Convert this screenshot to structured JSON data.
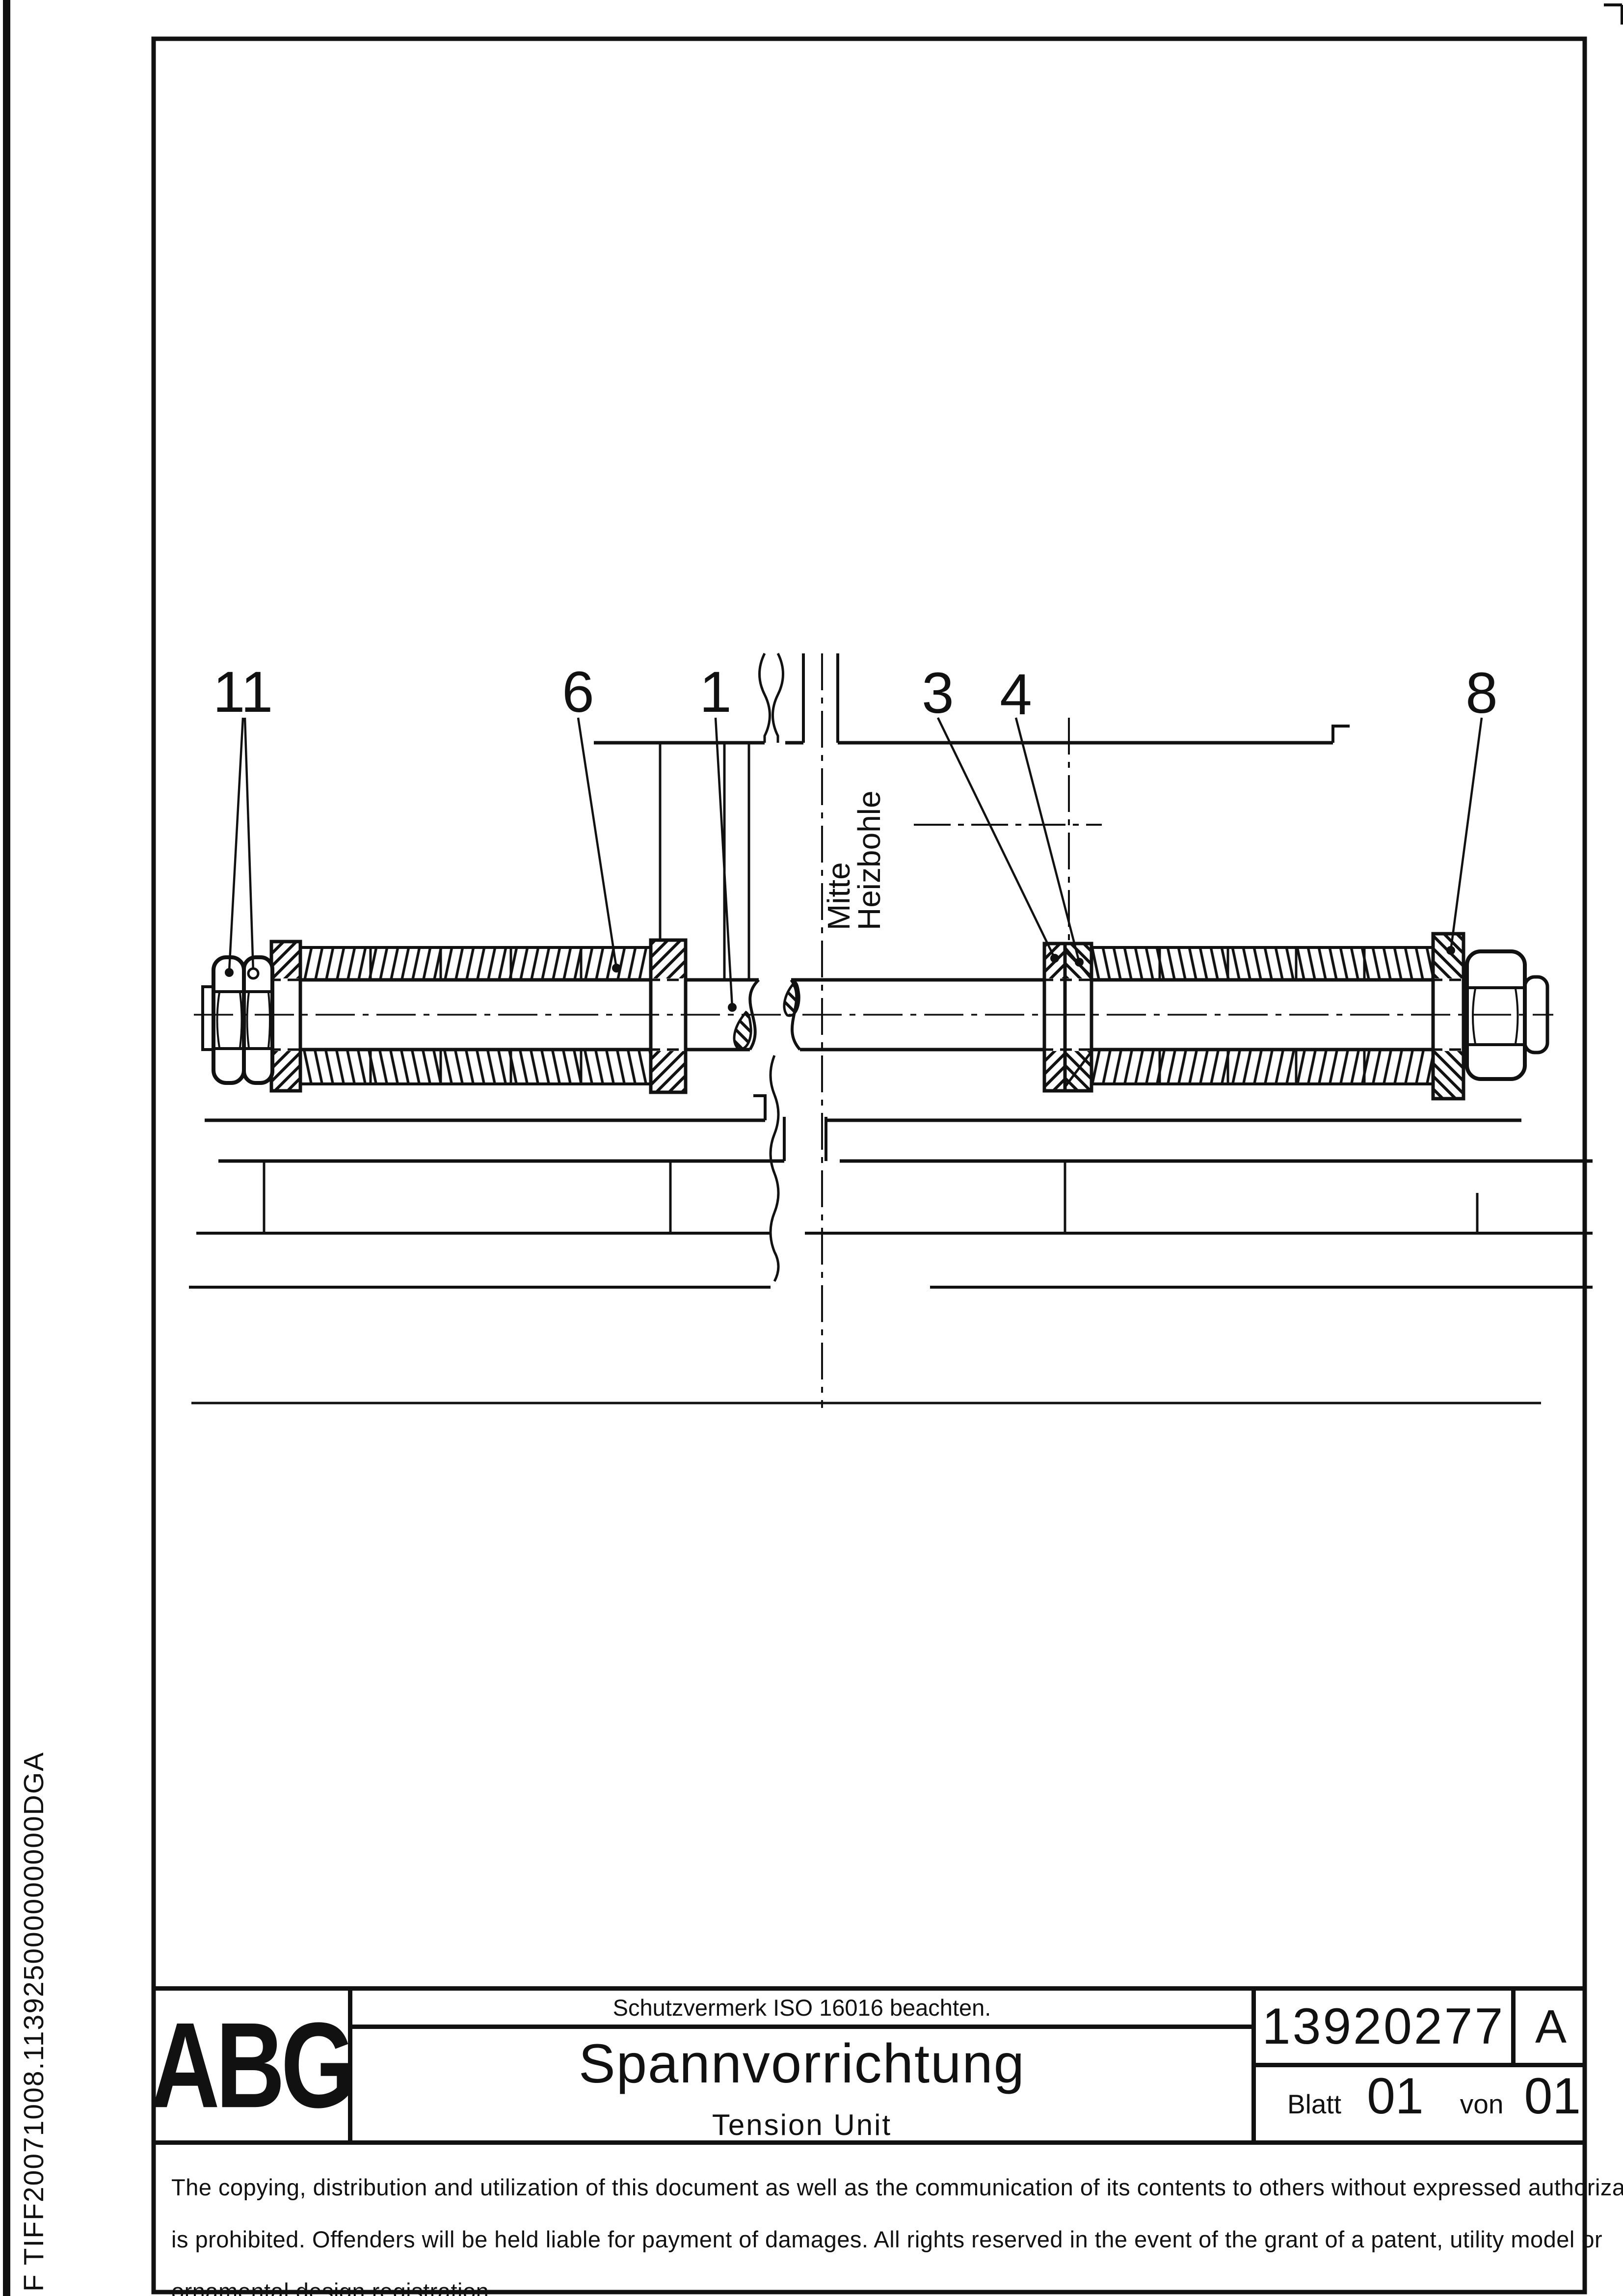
{
  "page": {
    "background": "#ffffff",
    "ink": "#111111",
    "file_label_vertical": "F TIFF20071008.113925000000000DGA"
  },
  "drawing": {
    "part_labels": [
      {
        "id": "11"
      },
      {
        "id": "6"
      },
      {
        "id": "1"
      },
      {
        "id": "3"
      },
      {
        "id": "4"
      },
      {
        "id": "8"
      }
    ],
    "axis_label": {
      "line1": "Mitte",
      "line2": "Heizbohle"
    }
  },
  "title_block": {
    "logo": "ABG",
    "protection_notice": "Schutzvermerk ISO 16016 beachten.",
    "title": "Spannvorrichtung",
    "subtitle": "Tension Unit",
    "document_number": "13920277",
    "revision": "A",
    "sheet_word": "Blatt",
    "sheet_number": "01",
    "of_word": "von",
    "sheet_total": "01"
  },
  "disclaimer": {
    "line1": "The copying, distribution and utilization of this document as well as the communication of its contents to others without expressed authorization",
    "line2": "is prohibited. Offenders will be held liable for payment of damages. All rights reserved in the event of the grant of a patent, utility model or",
    "line3": "ornamental design registration."
  }
}
